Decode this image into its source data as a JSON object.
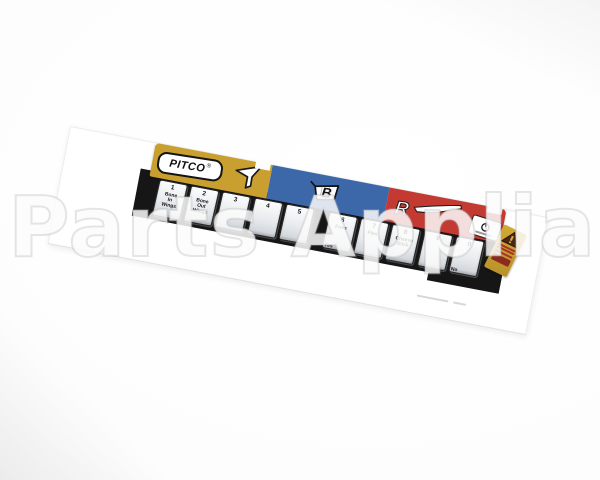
{
  "watermark": {
    "text": "Parts Appliance"
  },
  "decal": {
    "brand_logo": "PITCO",
    "registered_mark": "®",
    "sections": {
      "yellow": {
        "name": "filter-section",
        "color": "#c9a030",
        "icon": "funnel-icon"
      },
      "blue": {
        "name": "basket-section",
        "color": "#3c67a9",
        "icon": "basket-icon",
        "letter": "B"
      },
      "red": {
        "name": "pan-section",
        "color": "#c23a31",
        "icon": "pan-icon",
        "letter": "R"
      }
    },
    "keypad": {
      "keys": [
        {
          "num": "1",
          "lines": [
            "Bone",
            "In",
            "Wings"
          ]
        },
        {
          "num": "2",
          "lines": [
            "Bone",
            "Out",
            "Wings"
          ]
        },
        {
          "num": "3",
          "lines": []
        },
        {
          "num": "4",
          "lines": []
        },
        {
          "num": "5",
          "lines": []
        },
        {
          "num": "6",
          "lines": [
            "Fries"
          ],
          "sub": "Yes"
        },
        {
          "num": "7",
          "lines": [
            "Flex"
          ]
        },
        {
          "num": "8",
          "lines": [
            "Cheese",
            "Stick"
          ]
        },
        {
          "num": "9",
          "lines": []
        },
        {
          "num": "0",
          "lines": [],
          "sub": "No"
        }
      ]
    },
    "power_badge": {
      "icon": "power-icon"
    },
    "warning_sticker": {
      "icon": "warning-triangle-icon"
    }
  },
  "colors": {
    "yellow": "#c9a030",
    "blue": "#3c67a9",
    "red": "#c23a31",
    "strip_black": "#161616",
    "key_face": "#eef0f3",
    "sticker_gold": "#c79d2b",
    "warning_red": "#a83226"
  }
}
